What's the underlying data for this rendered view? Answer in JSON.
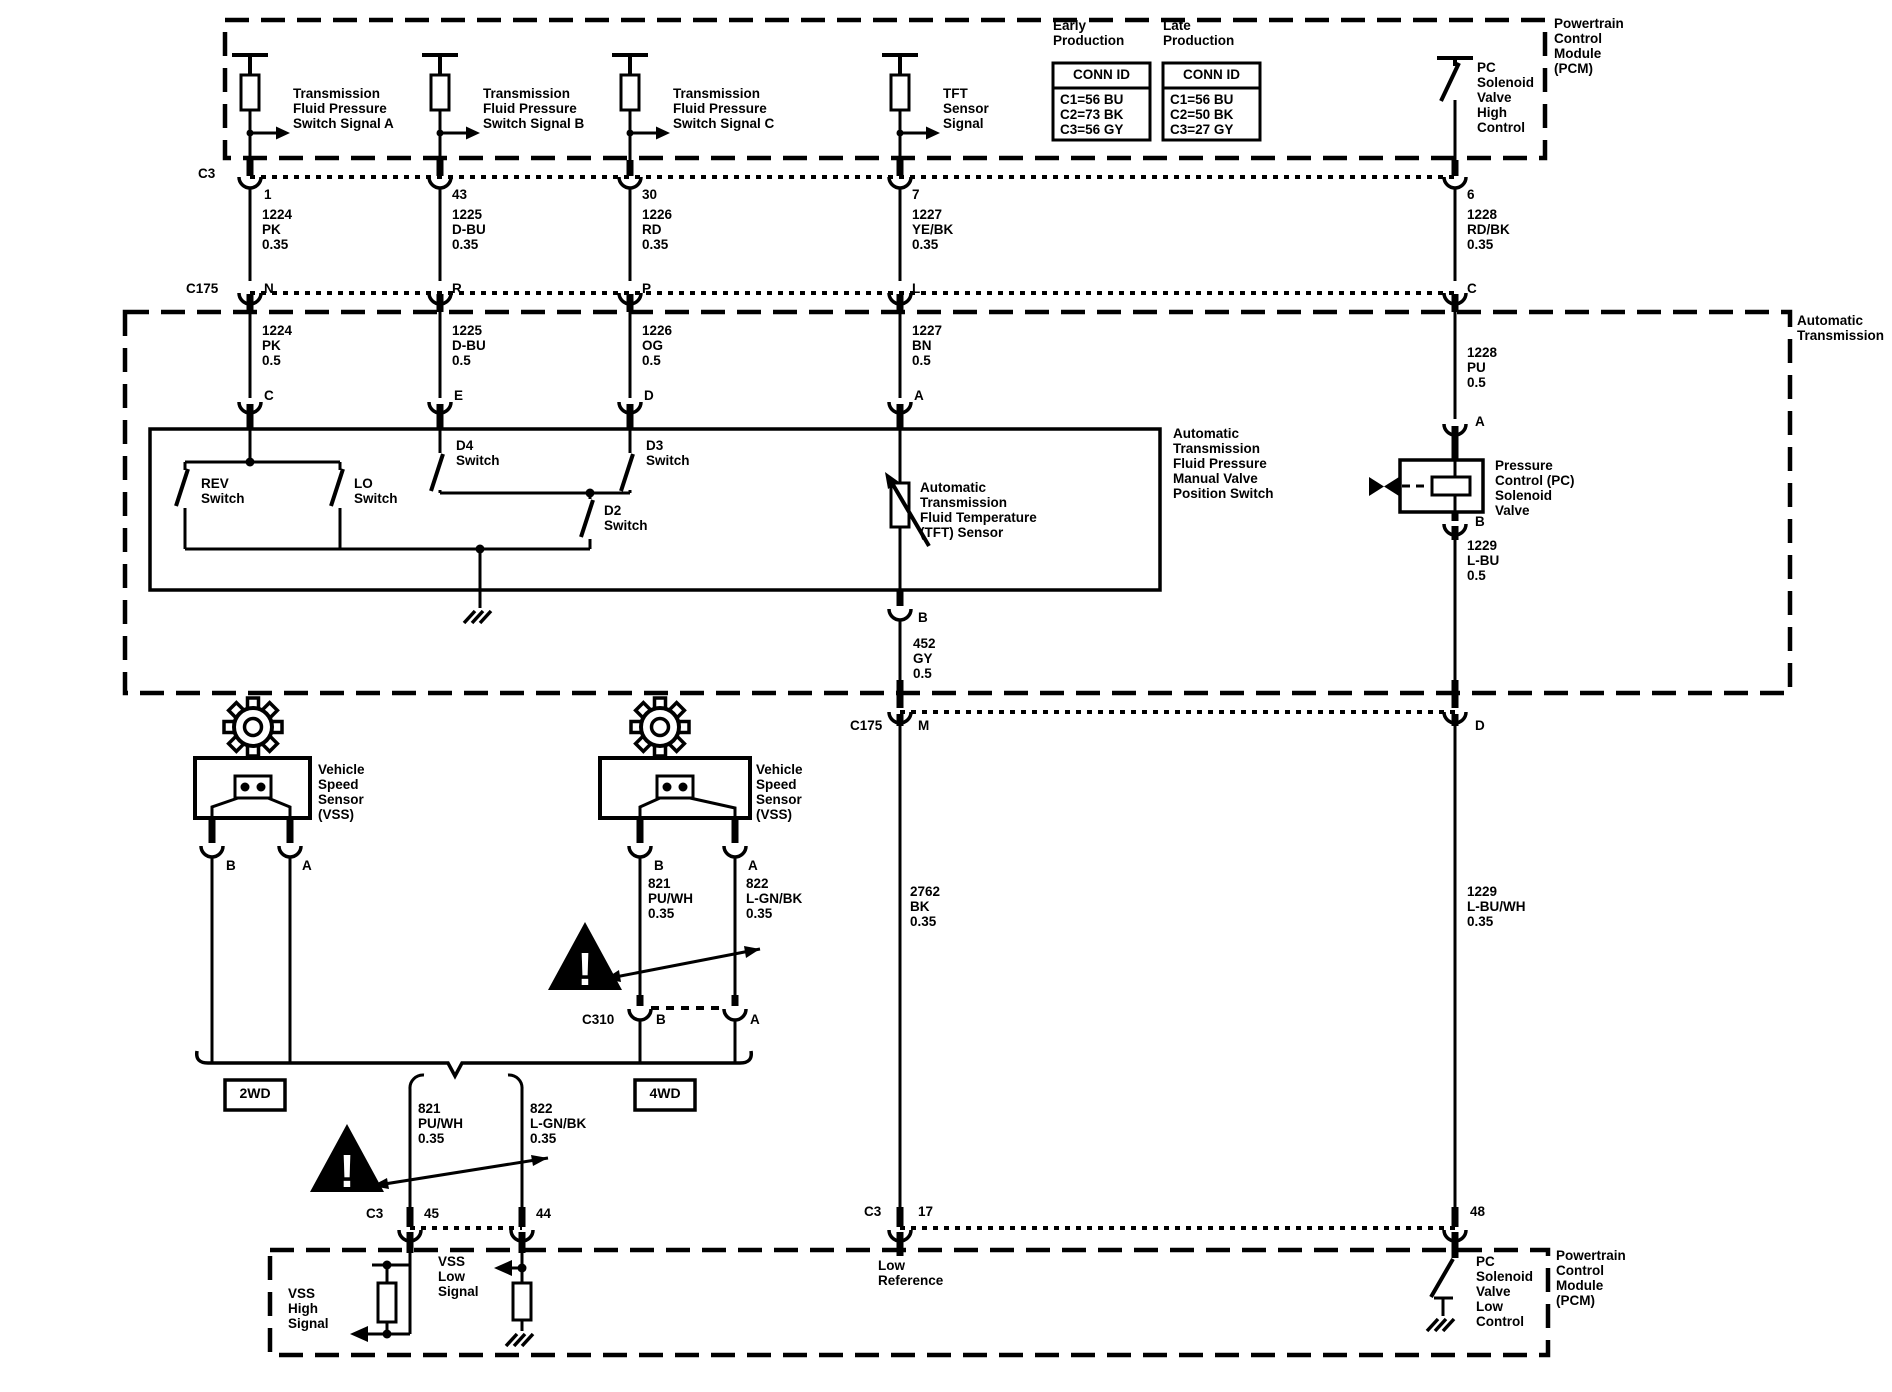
{
  "colors": {
    "ink": "#000000",
    "bg": "#ffffff"
  },
  "pcm_top": {
    "label": "Powertrain\nControl\nModule\n(PCM)",
    "signals": [
      "Transmission\nFluid Pressure\nSwitch Signal A",
      "Transmission\nFluid Pressure\nSwitch Signal B",
      "Transmission\nFluid Pressure\nSwitch Signal C",
      "TFT\nSensor\nSignal"
    ],
    "pc_solenoid_high": "PC\nSolenoid\nValve\nHigh\nControl",
    "early": {
      "title": "Early\nProduction",
      "header": "CONN ID",
      "rows": "C1=56 BU\nC2=73 BK\nC3=56 GY"
    },
    "late": {
      "title": "Late\nProduction",
      "header": "CONN ID",
      "rows": "C1=56 BU\nC2=50 BK\nC3=27 GY"
    }
  },
  "c3_top": {
    "name": "C3",
    "pins": [
      "1",
      "43",
      "30",
      "7",
      "6"
    ]
  },
  "top_wires": [
    "1224\nPK\n0.35",
    "1225\nD-BU\n0.35",
    "1226\nRD\n0.35",
    "1227\nYE/BK\n0.35",
    "1228\nRD/BK\n0.35"
  ],
  "c175": {
    "name": "C175",
    "pins": [
      "N",
      "R",
      "P",
      "L",
      "C"
    ]
  },
  "at_wires": [
    "1224\nPK\n0.5",
    "1225\nD-BU\n0.5",
    "1226\nOG\n0.5",
    "1227\nBN\n0.5",
    "1228\nPU\n0.5"
  ],
  "at_box_label": "Automatic\nTransmission",
  "switch_box": {
    "pins": [
      "C",
      "E",
      "D",
      "A"
    ],
    "rev": "REV\nSwitch",
    "lo": "LO\nSwitch",
    "d4": "D4\nSwitch",
    "d3": "D3\nSwitch",
    "d2": "D2\nSwitch",
    "label": "Automatic\nTransmission\nFluid Pressure\nManual Valve\nPosition Switch"
  },
  "tft": {
    "label": "Automatic\nTransmission\nFluid Temperature\n(TFT) Sensor",
    "pin_b": "B",
    "wire": "452\nGY\n0.5"
  },
  "pc_valve": {
    "pin_a": "A",
    "pin_b": "B",
    "label": "Pressure\nControl (PC)\nSolenoid\nValve",
    "wire_below": "1229\nL-BU\n0.5"
  },
  "c175_2": {
    "name": "C175",
    "pin_m": "M",
    "pin_d": "D"
  },
  "long_wires": {
    "w2762": "2762\nBK\n0.35",
    "w1229": "1229\nL-BU/WH\n0.35"
  },
  "vss_left": {
    "label": "Vehicle\nSpeed\nSensor\n(VSS)",
    "pin_b": "B",
    "pin_a": "A"
  },
  "vss_right": {
    "label": "Vehicle\nSpeed\nSensor\n(VSS)",
    "pin_b": "B",
    "pin_a": "A",
    "wire_b": "821\nPU/WH\n0.35",
    "wire_a": "822\nL-GN/BK\n0.35"
  },
  "c310": {
    "name": "C310",
    "pin_b": "B",
    "pin_a": "A"
  },
  "drive": {
    "two_wd": "2WD",
    "four_wd": "4WD"
  },
  "lower_pair": {
    "w821": "821\nPU/WH\n0.35",
    "w822": "822\nL-GN/BK\n0.35"
  },
  "c3_bottom_left": {
    "name": "C3",
    "pin_45": "45",
    "pin_44": "44"
  },
  "c3_bottom_right": {
    "name": "C3",
    "pin_17": "17",
    "pin_48": "48"
  },
  "pcm_bottom": {
    "label": "Powertrain\nControl\nModule\n(PCM)",
    "vss_high": "VSS\nHigh\nSignal",
    "vss_low": "VSS\nLow\nSignal",
    "low_ref": "Low\nReference",
    "pc_solenoid_low": "PC\nSolenoid\nValve\nLow\nControl"
  },
  "warning_glyph": "!"
}
